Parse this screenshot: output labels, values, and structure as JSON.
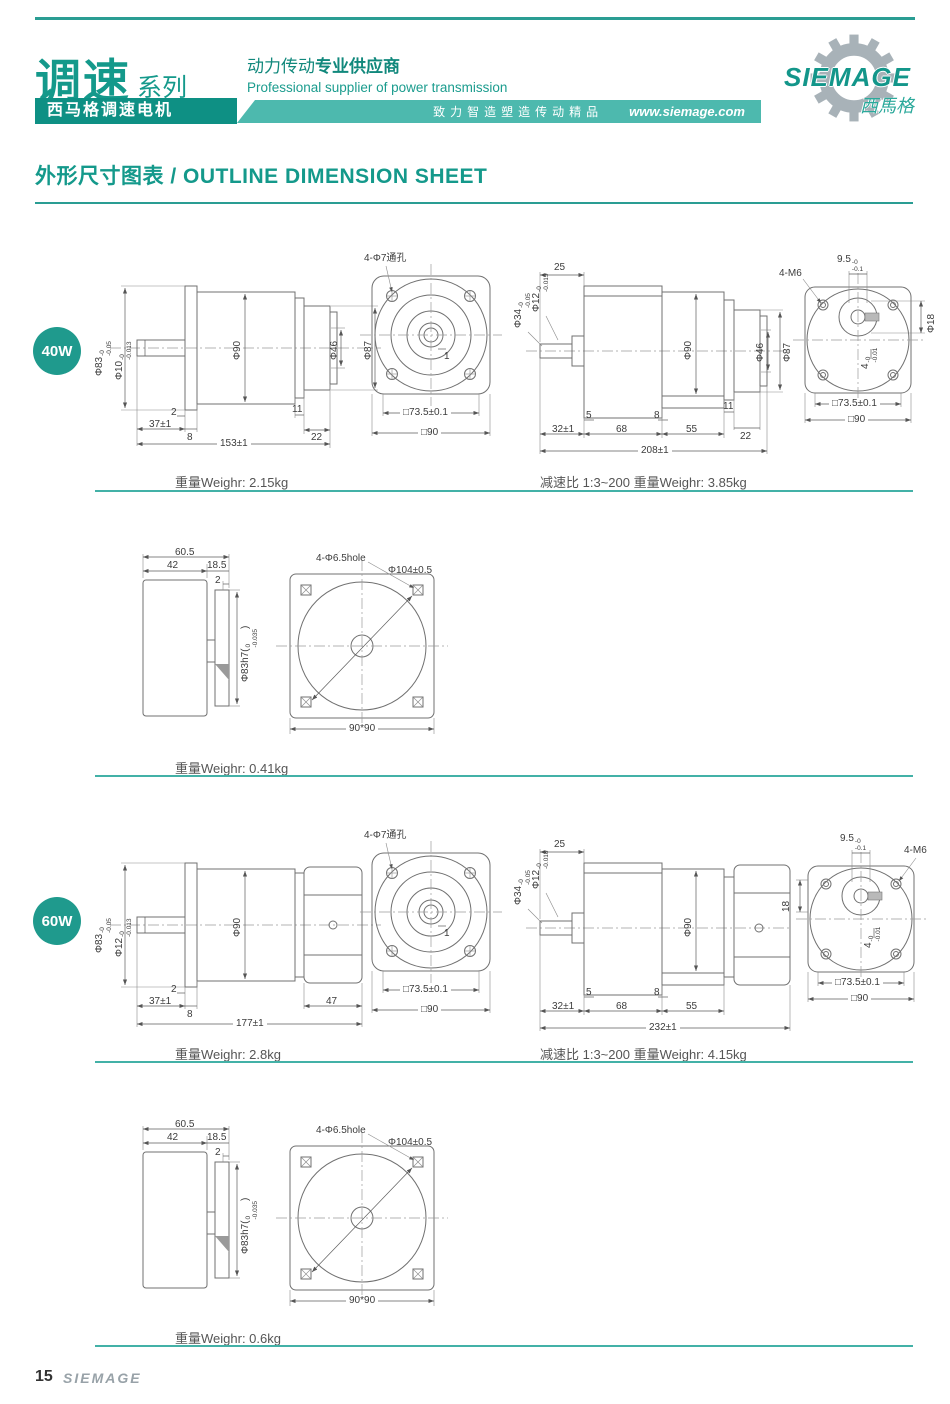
{
  "header": {
    "series_cn": "调速",
    "series_suffix": "系列",
    "product_bar": "西马格调速电机",
    "tagline_cn": "动力传动",
    "tagline_cn_bold": "专业供应商",
    "tagline_en": "Professional supplier of power transmission",
    "slogan": "致力智造塑造传动精品",
    "website": "www.siemage.com",
    "brand": "SIEMAGE",
    "brand_cn": "西馬格"
  },
  "title": "外形尺寸图表 / OUTLINE DIMENSION SHEET",
  "sections": [
    {
      "badge": "40W",
      "weights": {
        "motor": "重量Weighr: 2.15kg",
        "gear": "减速比 1:3~200  重量Weighr: 3.85kg",
        "fan": "重量Weighr: 0.41kg"
      },
      "motor_side": {
        "d83": {
          "main": "Φ83",
          "top": "-0",
          "bot": "-0.05"
        },
        "d10": {
          "main": "Φ10",
          "top": "-0",
          "bot": "-0.013"
        },
        "d90": "Φ90",
        "d46": "Φ46",
        "d87": "Φ87",
        "l2": "2",
        "l37": "37±1",
        "l8": "8",
        "l11": "11",
        "l22": "22",
        "total": "153±1"
      },
      "front_view": {
        "holes": "4-Φ7通孔",
        "l1": "1",
        "sq735": "□73.5±0.1",
        "sq90": "□90"
      },
      "gear_side": {
        "d34": {
          "main": "Φ34",
          "top": "-0",
          "bot": "-0.05"
        },
        "d12": {
          "main": "Φ12",
          "top": "-0",
          "bot": "-0.015"
        },
        "l25": "25",
        "d90": "Φ90",
        "d46": "Φ46",
        "d87": "Φ87",
        "l5": "5",
        "l8": "8",
        "l11": "11",
        "l22": "22",
        "l32": "32±1",
        "l68": "68",
        "l55": "55",
        "total": "208±1"
      },
      "rear_view": {
        "m6": "4-M6",
        "n95": {
          "main": "9.5",
          "top": "-0",
          "bot": "-0.1"
        },
        "d18": "Φ18",
        "key": {
          "main": "4",
          "top": "-0",
          "bot": "-0.01"
        },
        "sq735": "□73.5±0.1",
        "sq90": "□90"
      },
      "fan_side": {
        "l605": "60.5",
        "l42": "42",
        "l185": "18.5",
        "l2": "2",
        "shaft": {
          "pre": "Φ83h7(",
          "top": "0",
          "bot": "-0.035",
          "post": ")"
        }
      },
      "fan_front": {
        "holes": "4-Φ6.5hole",
        "d104": "Φ104±0.5",
        "sq": "90*90"
      }
    },
    {
      "badge": "60W",
      "weights": {
        "motor": "重量Weighr: 2.8kg",
        "gear": "减速比 1:3~200  重量Weighr: 4.15kg",
        "fan": "重量Weighr: 0.6kg"
      },
      "motor_side": {
        "d83": {
          "main": "Φ83",
          "top": "-0",
          "bot": "-0.05"
        },
        "d12": {
          "main": "Φ12",
          "top": "-0",
          "bot": "-0.013"
        },
        "d90": "Φ90",
        "l2": "2",
        "l37": "37±1",
        "l8": "8",
        "l47": "47",
        "total": "177±1"
      },
      "front_view": {
        "holes": "4-Φ7通孔",
        "l1": "1",
        "sq735": "□73.5±0.1",
        "sq90": "□90"
      },
      "gear_side": {
        "d34": {
          "main": "Φ34",
          "top": "-0",
          "bot": "-0.05"
        },
        "d12": {
          "main": "Φ12",
          "top": "-0",
          "bot": "-0.018"
        },
        "l25": "25",
        "d90": "Φ90",
        "l5": "5",
        "l8": "8",
        "l32": "32±1",
        "l68": "68",
        "l55": "55",
        "total": "232±1"
      },
      "rear_view": {
        "m6": "4-M6",
        "n95": {
          "main": "9.5",
          "top": "-0",
          "bot": "-0.1"
        },
        "l18": "18",
        "key": {
          "main": "4",
          "top": "-0",
          "bot": "-0.01"
        },
        "sq735": "□73.5±0.1",
        "sq90": "□90"
      },
      "fan_side": {
        "l605": "60.5",
        "l42": "42",
        "l185": "18.5",
        "l2": "2",
        "shaft": {
          "pre": "Φ83h7(",
          "top": "0",
          "bot": "-0.035",
          "post": ")"
        }
      },
      "fan_front": {
        "holes": "4-Φ6.5hole",
        "d104": "Φ104±0.5",
        "sq": "90*90"
      }
    }
  ],
  "footer": {
    "page_number": "15",
    "brand": "SIEMAGE"
  }
}
